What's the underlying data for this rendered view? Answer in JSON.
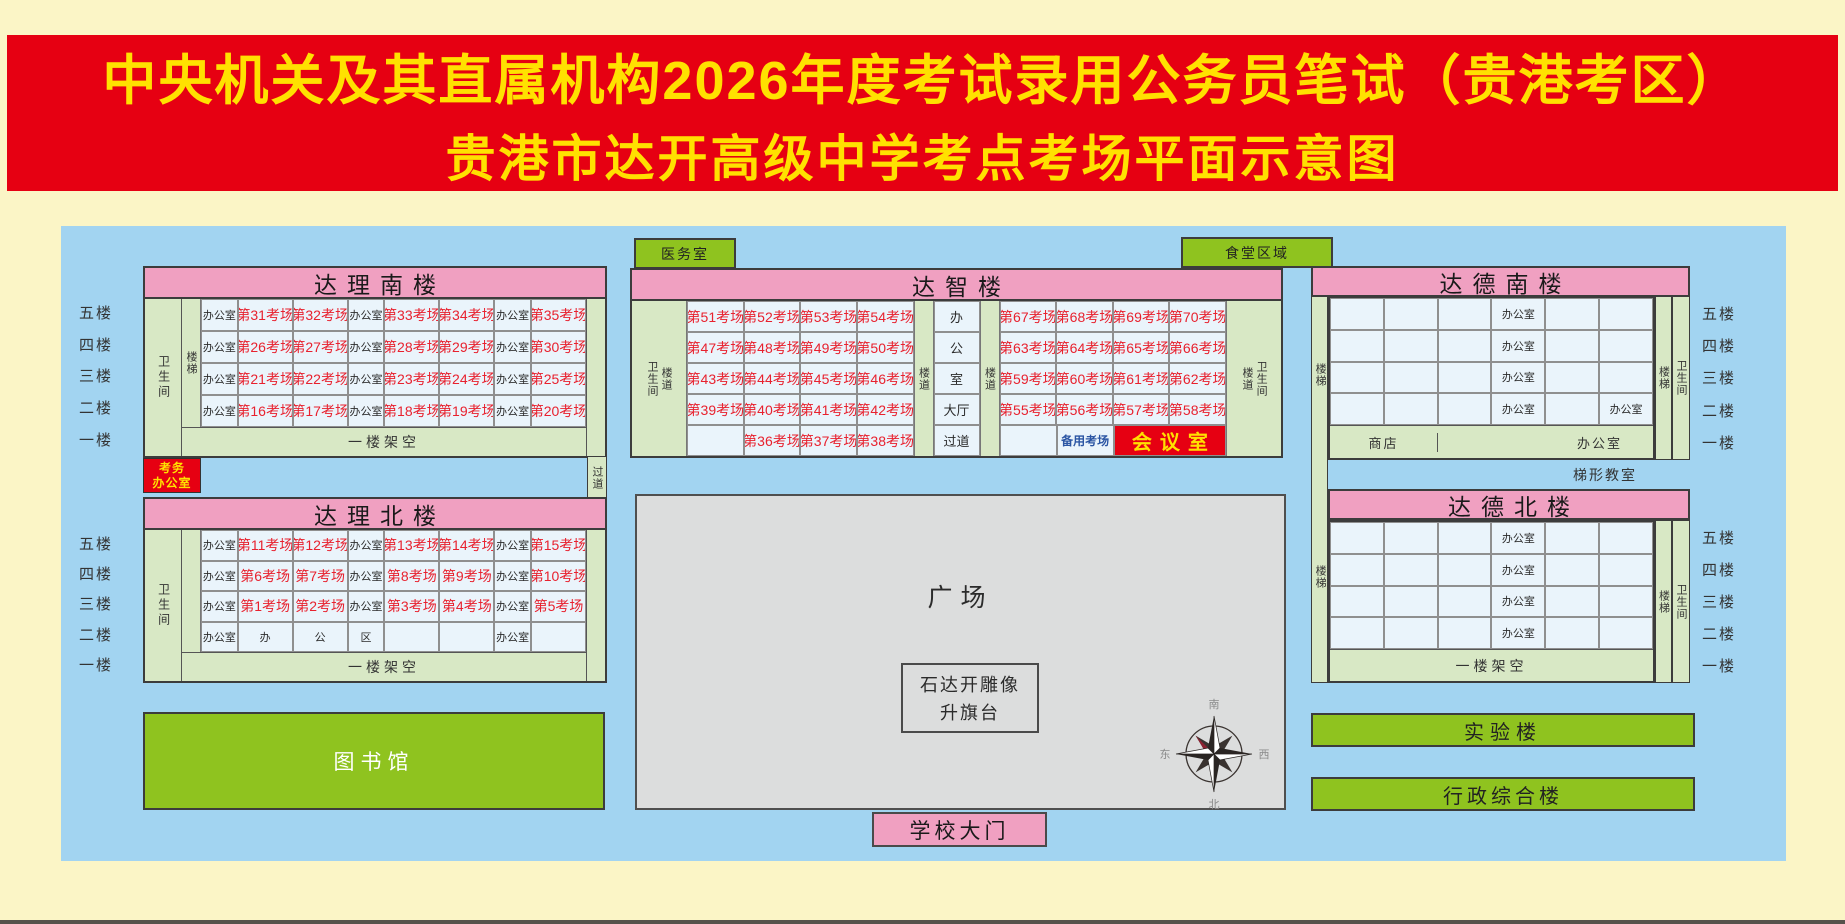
{
  "banner": {
    "line1": "中央机关及其直属机构2026年度考试录用公务员笔试（贵港考区）",
    "line2": "贵港市达开高级中学考点考场平面示意图"
  },
  "colors": {
    "banner_red": "#E60012",
    "banner_yellow": "#FFE100",
    "panel_blue": "#A2D4F1",
    "pink": "#F0A0C1",
    "pale_green": "#D8E8C5",
    "cell_blue": "#EAF4FB",
    "block_green": "#8FC31F",
    "plaza_gray": "#DCDDDD",
    "exam_red": "#E8212E",
    "reserve_blue": "#2B55A3"
  },
  "dali_south": {
    "name": "达理南楼",
    "toilet": "卫生间",
    "stair": "楼梯",
    "floor_labels": [
      "五楼",
      "四楼",
      "三楼",
      "二楼",
      "一楼"
    ],
    "rows": [
      [
        "办公室",
        "第31考场",
        "第32考场",
        "办公室",
        "第33考场",
        "第34考场",
        "办公室",
        "第35考场"
      ],
      [
        "办公室",
        "第26考场",
        "第27考场",
        "办公室",
        "第28考场",
        "第29考场",
        "办公室",
        "第30考场"
      ],
      [
        "办公室",
        "第21考场",
        "第22考场",
        "办公室",
        "第23考场",
        "第24考场",
        "办公室",
        "第25考场"
      ],
      [
        "办公室",
        "第16考场",
        "第17考场",
        "办公室",
        "第18考场",
        "第19考场",
        "办公室",
        "第20考场"
      ]
    ],
    "ground": "一楼架空"
  },
  "exam_office": {
    "line1": "考务",
    "line2": "办公室"
  },
  "corridor": "过道",
  "dali_north": {
    "name": "达理北楼",
    "toilet": "卫生间",
    "floor_labels": [
      "五楼",
      "四楼",
      "三楼",
      "二楼",
      "一楼"
    ],
    "rows": [
      [
        "办公室",
        "第11考场",
        "第12考场",
        "办公室",
        "第13考场",
        "第14考场",
        "办公室",
        "第15考场"
      ],
      [
        "办公室",
        "第6考场",
        "第7考场",
        "办公室",
        "第8考场",
        "第9考场",
        "办公室",
        "第10考场"
      ],
      [
        "办公室",
        "第1考场",
        "第2考场",
        "办公室",
        "第3考场",
        "第4考场",
        "办公室",
        "第5考场"
      ],
      [
        "办公室",
        "办",
        "公",
        "区",
        "",
        "",
        "办公室",
        ""
      ]
    ],
    "ground": "一楼架空"
  },
  "library": "图书馆",
  "clinic": "医务室",
  "canteen": "食堂区域",
  "dazhi": {
    "name": "达智楼",
    "left_edge": [
      "卫生间",
      "楼道"
    ],
    "right_edge": [
      "楼道",
      "卫生间"
    ],
    "aisle": "楼道",
    "mid": [
      "办",
      "公",
      "室",
      "大厅",
      "过道"
    ],
    "left_rows": [
      [
        "第51考场",
        "第52考场",
        "第53考场",
        "第54考场"
      ],
      [
        "第47考场",
        "第48考场",
        "第49考场",
        "第50考场"
      ],
      [
        "第43考场",
        "第44考场",
        "第45考场",
        "第46考场"
      ],
      [
        "第39考场",
        "第40考场",
        "第41考场",
        "第42考场"
      ],
      [
        "",
        "第36考场",
        "第37考场",
        "第38考场"
      ]
    ],
    "right_rows": [
      [
        "第67考场",
        "第68考场",
        "第69考场",
        "第70考场"
      ],
      [
        "第63考场",
        "第64考场",
        "第65考场",
        "第66考场"
      ],
      [
        "第59考场",
        "第60考场",
        "第61考场",
        "第62考场"
      ],
      [
        "第55考场",
        "第56考场",
        "第57考场",
        "第58考场"
      ]
    ],
    "last_row": {
      "reserve": "备用考场",
      "meeting": "会议室"
    }
  },
  "plaza": {
    "label": "广场",
    "statue_line1": "石达开雕像",
    "statue_line2": "升旗台",
    "gate": "学校大门",
    "compass": {
      "north": "北",
      "south": "南",
      "east": "东",
      "west": "西"
    }
  },
  "dade_south": {
    "name": "达德南楼",
    "stair": "楼梯",
    "toilet": "卫生间",
    "floor_labels": [
      "五楼",
      "四楼",
      "三楼",
      "二楼",
      "一楼"
    ],
    "rows": [
      [
        "",
        "",
        "",
        "办公室",
        "",
        ""
      ],
      [
        "",
        "",
        "",
        "办公室",
        "",
        ""
      ],
      [
        "",
        "",
        "",
        "办公室",
        "",
        ""
      ],
      [
        "",
        "",
        "",
        "办公室",
        "",
        "办公室"
      ]
    ],
    "ground": {
      "shop": "商店",
      "middle": "",
      "office": "办公室"
    }
  },
  "trapezoid_room": "梯形教室",
  "dade_north": {
    "name": "达德北楼",
    "stair": "楼梯",
    "toilet": "卫生间",
    "floor_labels": [
      "五楼",
      "四楼",
      "三楼",
      "二楼",
      "一楼"
    ],
    "rows": [
      [
        "",
        "",
        "",
        "办公室",
        "",
        ""
      ],
      [
        "",
        "",
        "",
        "办公室",
        "",
        ""
      ],
      [
        "",
        "",
        "",
        "办公室",
        "",
        ""
      ],
      [
        "",
        "",
        "",
        "办公室",
        "",
        ""
      ]
    ],
    "ground": "一楼架空"
  },
  "lab": "实验楼",
  "admin": "行政综合楼"
}
